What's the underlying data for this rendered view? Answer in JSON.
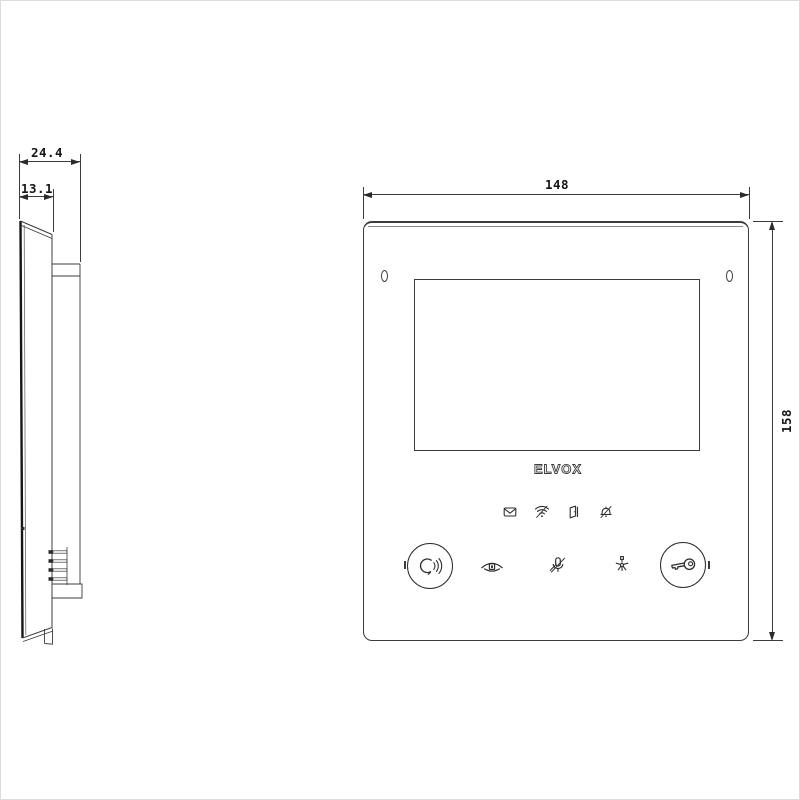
{
  "drawing": {
    "kind": "technical-dimension-drawing",
    "line_color": "#3c3c3c",
    "background": "#ffffff"
  },
  "side_view": {
    "dim_total_depth": "24.4",
    "dim_front_depth": "13.1"
  },
  "front_view": {
    "dim_width": "148",
    "dim_height": "158",
    "logo": "ELVOX",
    "status_icons": [
      "voicemail-icon",
      "wifi-icon",
      "door-open-icon",
      "bell-muted-icon"
    ],
    "touch_controls": [
      "talk-button",
      "self-start-eye-icon",
      "mic-mute-icon",
      "stair-light-icon",
      "door-release-key-button"
    ]
  }
}
